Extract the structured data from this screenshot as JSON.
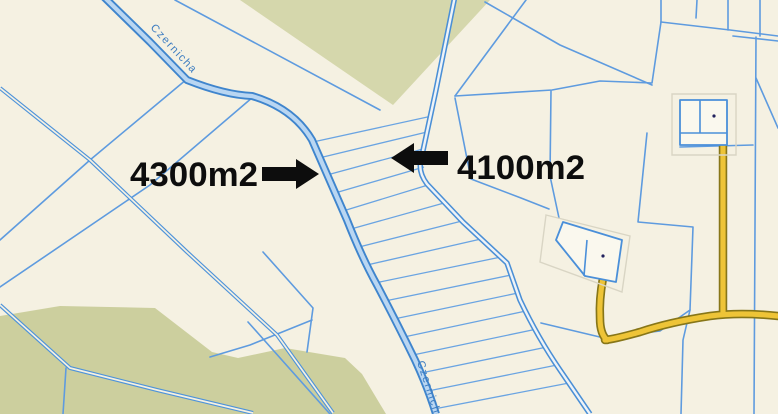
{
  "map": {
    "stream_label": "Czernicha",
    "area_labels": [
      {
        "text": "4300m2",
        "arrow_direction": "right"
      },
      {
        "text": "4100m2",
        "arrow_direction": "left"
      }
    ],
    "palette": {
      "background": "#f5f1e2",
      "parcel_line": "#5e9bdf",
      "stream_blue": "#3f85cd",
      "stream_water": "#b9d6f2",
      "vegetation_top": "#d5d7ac",
      "vegetation_bottom": "#cccf9e",
      "road_fill": "#eec437",
      "road_casing": "#877618",
      "building_fill": "#faf8ee",
      "building_outline": "#4a8fd9",
      "annotation_color": "#0d0d0d",
      "stream_label_color": "#3c7cc0"
    }
  }
}
